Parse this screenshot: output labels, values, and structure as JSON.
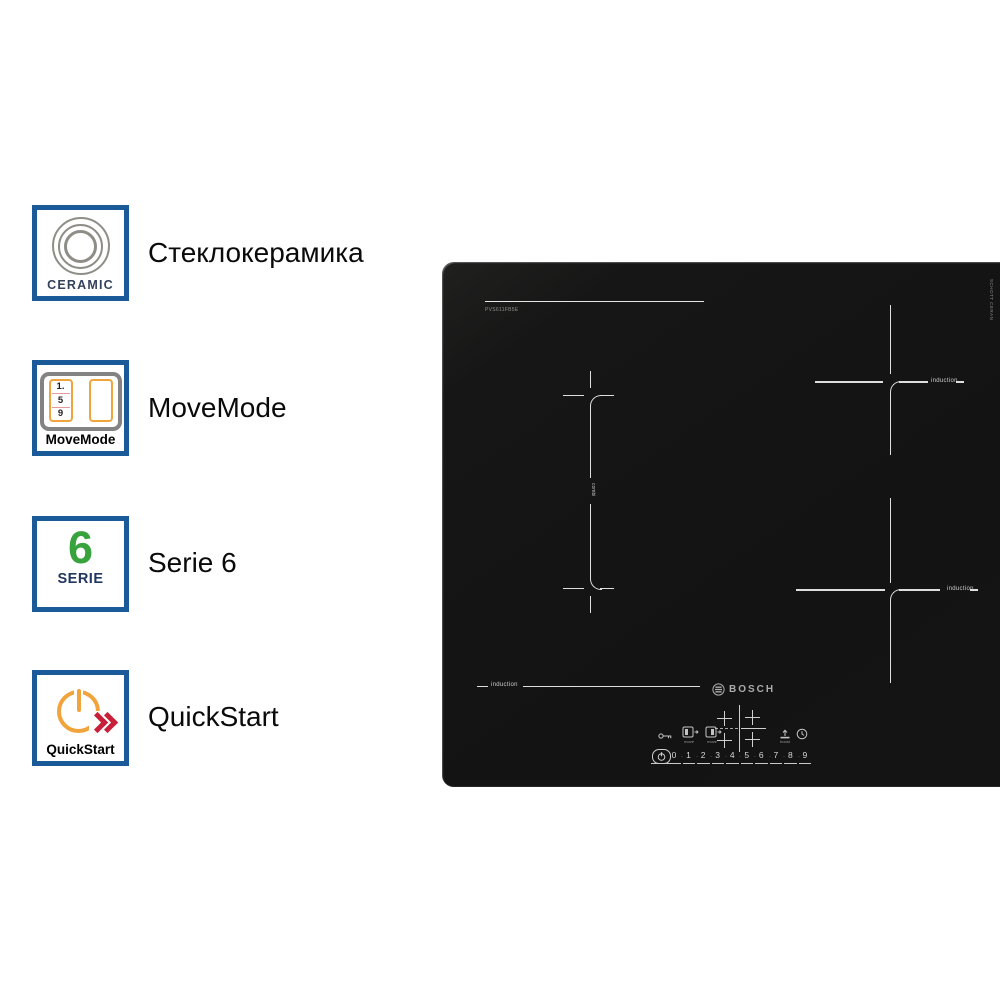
{
  "colors": {
    "badge_border": "#1a5a99",
    "movemode_orange": "#f0a43c",
    "serie_green": "#38a23c",
    "quickstart_orange": "#f2a43c",
    "quickstart_red": "#c9203a",
    "cooktop_black": "#141414"
  },
  "badges": {
    "ceramic": {
      "caption": "CERAMIC",
      "label": "Стеклокерамика"
    },
    "movemode": {
      "caption": "MoveMode",
      "label": "MoveMode",
      "digits": [
        "1.",
        "5",
        "9"
      ]
    },
    "serie": {
      "number": "6",
      "caption": "SERIE",
      "label": "Serie 6"
    },
    "quickstart": {
      "caption": "QuickStart",
      "label": "QuickStart"
    }
  },
  "cooktop": {
    "brand": "BOSCH",
    "model": "PVS611FB5E",
    "edge_print": "SCHOTT CERAN",
    "flex_label": "combi",
    "zone_left_label": "induction",
    "zone_top_right_label": "induction",
    "zone_bottom_right_label": "induction",
    "controls": {
      "move_left_label": "move",
      "move_right_label": "move",
      "boost_label": "boost",
      "digits": [
        "0",
        "1",
        "2",
        "3",
        "4",
        "5",
        "6",
        "7",
        "8",
        "9"
      ],
      "separator": "·"
    }
  }
}
